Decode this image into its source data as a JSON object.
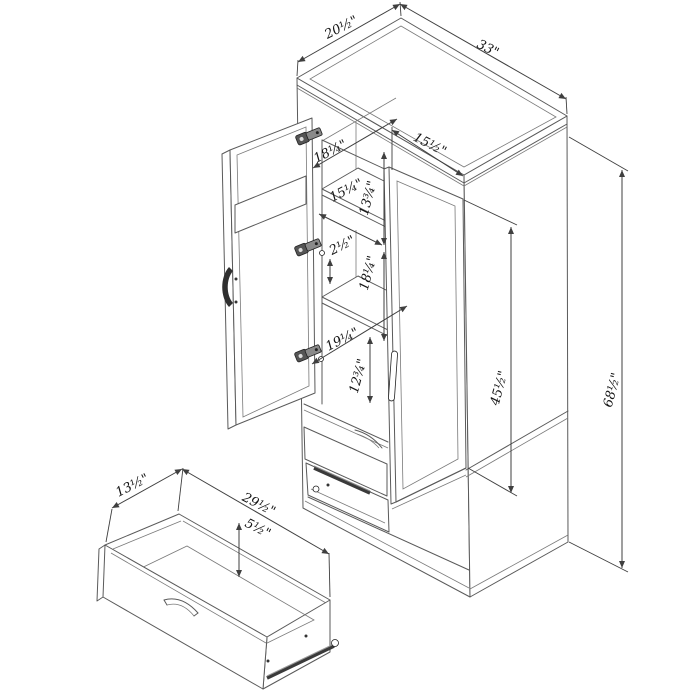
{
  "colors": {
    "background": "#ffffff",
    "line": "#5a5a5a",
    "dimension_line": "#3f3f3f",
    "text": "#141414",
    "hardware": "#333333"
  },
  "drawing": {
    "description": "Isometric dimension drawing of a two-door wardrobe armoire with interior shelves and bottom storage drawers; one drawer shown removed at lower left",
    "dims": [
      {
        "name": "top-depth",
        "text": "20½\""
      },
      {
        "name": "top-width",
        "text": "33\""
      },
      {
        "name": "interior-top-depth",
        "text": "18¼\""
      },
      {
        "name": "right-door-width",
        "text": "15½\""
      },
      {
        "name": "shelf-width",
        "text": "15¼\""
      },
      {
        "name": "upper-shelf-spacing",
        "text": "13¾\""
      },
      {
        "name": "shelf-gap",
        "text": "2½\""
      },
      {
        "name": "middle-section-height",
        "text": "18¼\""
      },
      {
        "name": "lower-interior-depth",
        "text": "19¼\""
      },
      {
        "name": "lower-section-height",
        "text": "12¾\""
      },
      {
        "name": "door-height",
        "text": "45½\""
      },
      {
        "name": "overall-height",
        "text": "68½\""
      },
      {
        "name": "drawer-depth",
        "text": "13½\""
      },
      {
        "name": "drawer-width",
        "text": "29½\""
      },
      {
        "name": "drawer-height",
        "text": "5½\""
      }
    ]
  }
}
